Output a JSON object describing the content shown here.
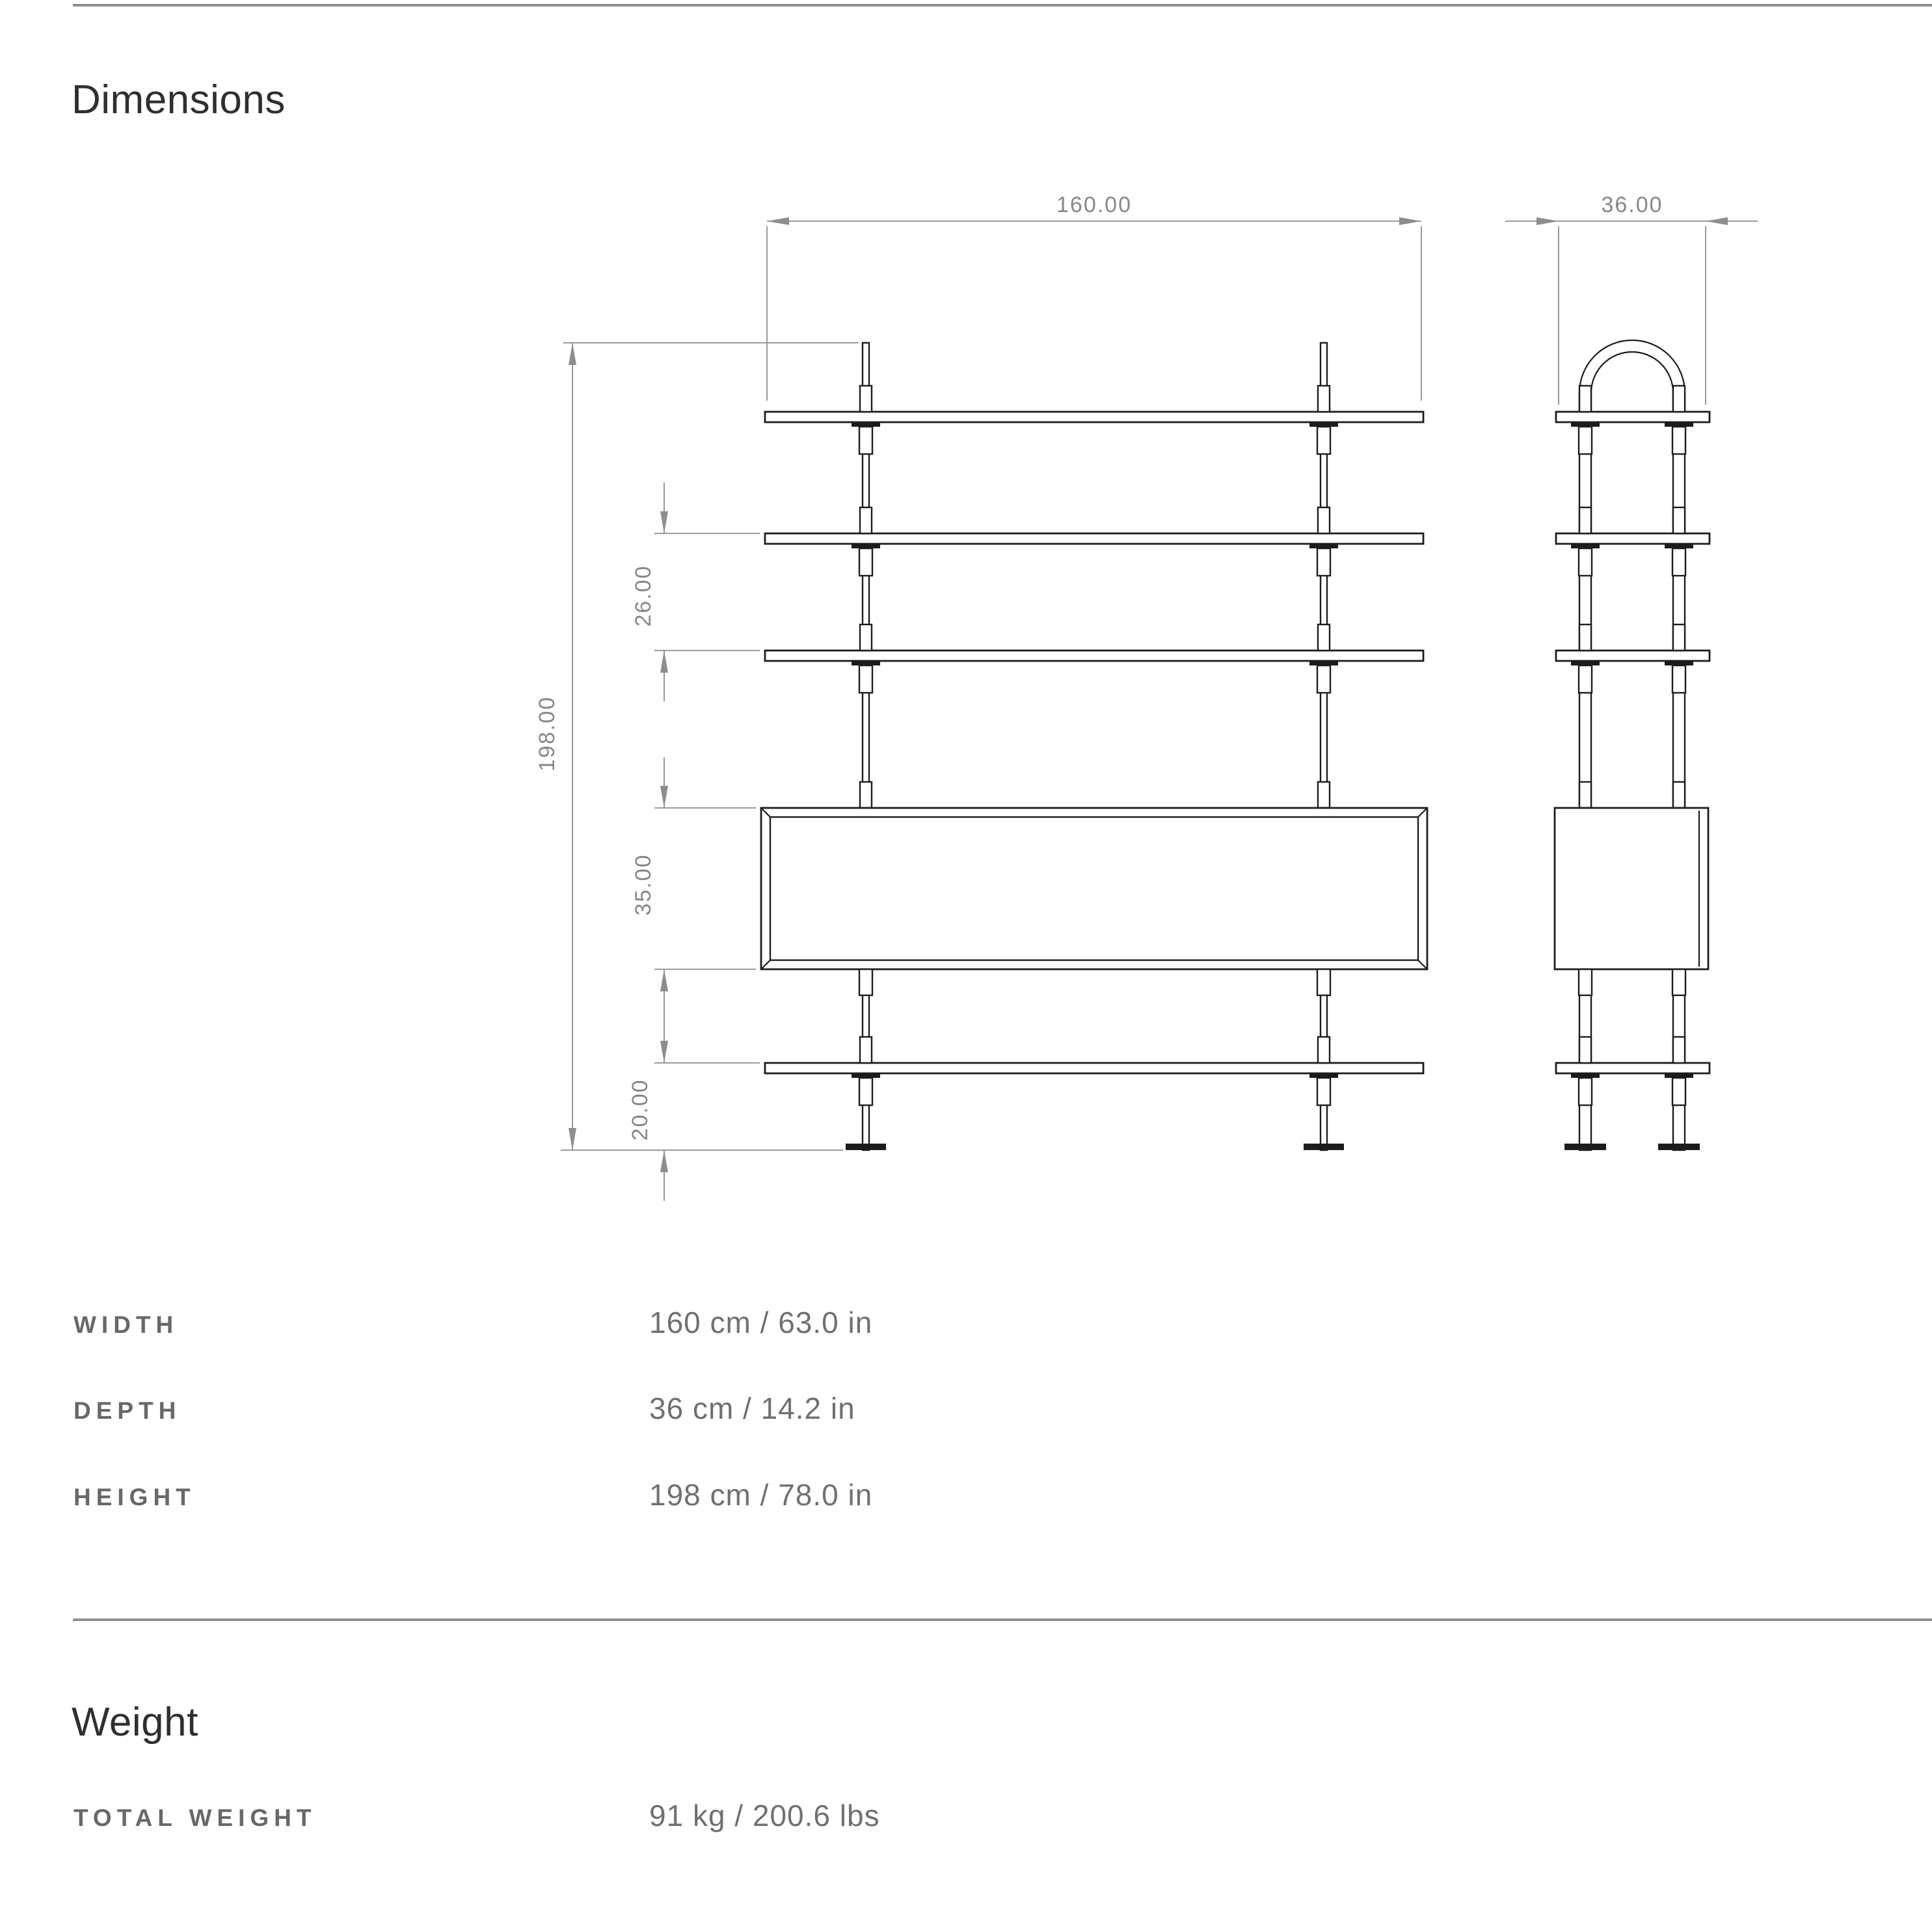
{
  "page": {
    "dimensions_section": {
      "heading": "Dimensions",
      "rows": [
        {
          "label": "WIDTH",
          "value": "160 cm / 63.0 in"
        },
        {
          "label": "DEPTH",
          "value": "36 cm / 14.2 in"
        },
        {
          "label": "HEIGHT",
          "value": "198 cm / 78.0 in"
        }
      ]
    },
    "weight_section": {
      "heading": "Weight",
      "rows": [
        {
          "label": "TOTAL WEIGHT",
          "value": "91 kg / 200.6 lbs"
        }
      ]
    }
  },
  "drawing": {
    "front_view": {
      "width_label": "160.00",
      "height_label": "198.00",
      "shelf_spacing_label": "26.00",
      "cabinet_height_label": "35.00",
      "ground_clearance_label": "20.00"
    },
    "side_view": {
      "depth_label": "36.00"
    },
    "colors": {
      "outline": "#1c1c1c",
      "dimension_gray": "#8b8e91"
    }
  }
}
